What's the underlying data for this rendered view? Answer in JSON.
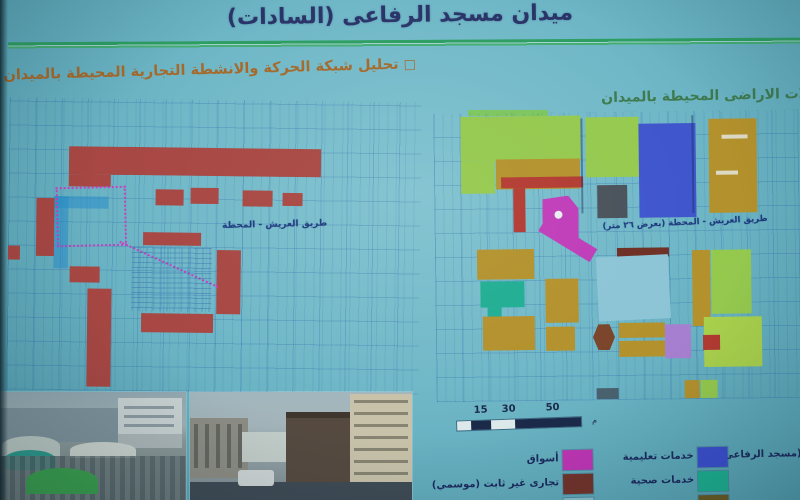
{
  "title": "ميدان مسجد الرفاعى (السادات)",
  "left_panel": {
    "bullet": "□",
    "header": "تحليل شبكة الحركة والانشطة التجارية المحيطة بالميدان",
    "street_label": "طريق العريش - المحطة"
  },
  "right_panel": {
    "header": "استعمالات الاراضى المحيطة بالميدان",
    "street_label": "طريق العريش - المحطة (بعرض ٢٦ متر)"
  },
  "scale_bar": {
    "ticks": [
      "15",
      "30",
      "50"
    ],
    "unit": "م"
  },
  "legend": {
    "items": [
      {
        "label": "(مسجد الرفاعى)",
        "color": "",
        "col": 0,
        "row": 0
      },
      {
        "label": "خدمات تعليمية",
        "color": "#3b4fd0",
        "col": 1,
        "row": 0
      },
      {
        "label": "أسواق",
        "color": "#bf35b5",
        "col": 2,
        "row": 0
      },
      {
        "label": "خدمات صحية",
        "color": "#1db191",
        "col": 1,
        "row": 1
      },
      {
        "label": "تجارى غير ثابت (موسمي)",
        "color": "#73332a",
        "col": 2,
        "row": 1
      },
      {
        "label": "",
        "color": "#6b5b22",
        "col": 1,
        "row": 2
      },
      {
        "label": "",
        "color": "#8cc0d0",
        "col": 2,
        "row": 2
      }
    ]
  },
  "colors": {
    "background": "#6fb7c7",
    "green_rule": "#2d9e62",
    "title_text": "#2a3468",
    "left_header_text": "#a5692b",
    "right_header_text": "#3e7a50",
    "grid_line": "#1e55a5",
    "commercial_red": "#a84743",
    "markets_magenta": "#bf35b5",
    "education_blue": "#3f55cc",
    "health_teal": "#1fae93",
    "residential_ochre": "#b3912c",
    "green_zone": "#95c94e",
    "lime_zone": "#a9d14c",
    "purple_zone": "#a77fd0",
    "mosque_brown": "#7a4429",
    "seasonal_maroon": "#6e2f24",
    "midan_lightblue": "#8cc4d6",
    "gray_zone": "#49525a"
  },
  "left_map": {
    "blocks": [
      {
        "x": 60,
        "y": 48,
        "w": 252,
        "h": 28,
        "c": "#a84743"
      },
      {
        "x": 60,
        "y": 76,
        "w": 42,
        "h": 12,
        "c": "#a84743"
      },
      {
        "x": 28,
        "y": 100,
        "w": 18,
        "h": 58,
        "c": "#a84743"
      },
      {
        "x": 80,
        "y": 190,
        "w": 24,
        "h": 98,
        "c": "#a84743"
      },
      {
        "x": 147,
        "y": 90,
        "w": 28,
        "h": 16,
        "c": "#a84743"
      },
      {
        "x": 182,
        "y": 88,
        "w": 28,
        "h": 16,
        "c": "#a84743"
      },
      {
        "x": 234,
        "y": 90,
        "w": 30,
        "h": 16,
        "c": "#a84743"
      },
      {
        "x": 274,
        "y": 92,
        "w": 20,
        "h": 13,
        "c": "#a84743"
      },
      {
        "x": 135,
        "y": 133,
        "w": 58,
        "h": 13,
        "c": "#a84743"
      },
      {
        "x": 209,
        "y": 150,
        "w": 24,
        "h": 64,
        "c": "#a84743"
      },
      {
        "x": 134,
        "y": 214,
        "w": 72,
        "h": 19,
        "c": "#a84743"
      },
      {
        "x": 62,
        "y": 168,
        "w": 30,
        "h": 16,
        "c": "#a84743"
      },
      {
        "x": 0,
        "y": 148,
        "w": 12,
        "h": 14,
        "c": "#a84743"
      },
      {
        "x": 46,
        "y": 98,
        "w": 14,
        "h": 72,
        "c": "rgba(40,140,200,0.55)"
      },
      {
        "x": 46,
        "y": 98,
        "w": 54,
        "h": 12,
        "c": "rgba(40,140,200,0.55)"
      }
    ]
  },
  "right_map": {
    "blocks": [
      {
        "x": 27,
        "y": 3,
        "w": 120,
        "h": 45,
        "c": "#95c94e"
      },
      {
        "x": 27,
        "y": 48,
        "w": 34,
        "h": 32,
        "c": "#95c94e"
      },
      {
        "x": 62,
        "y": 46,
        "w": 84,
        "h": 30,
        "c": "#b3912c"
      },
      {
        "x": 67,
        "y": 64,
        "w": 82,
        "h": 11,
        "c": "#b23a32"
      },
      {
        "x": 79,
        "y": 75,
        "w": 12,
        "h": 44,
        "c": "#b23a32"
      },
      {
        "x": 152,
        "y": 5,
        "w": 53,
        "h": 60,
        "c": "#95c94e"
      },
      {
        "x": 205,
        "y": 12,
        "w": 57,
        "h": 94,
        "c": "#3f55cc"
      },
      {
        "x": 275,
        "y": 8,
        "w": 48,
        "h": 94,
        "c": "#b3912c"
      },
      {
        "x": 288,
        "y": 24,
        "w": 26,
        "h": 4,
        "c": "rgba(230,236,236,0.8)"
      },
      {
        "x": 282,
        "y": 60,
        "w": 22,
        "h": 4,
        "c": "rgba(230,236,236,0.8)"
      },
      {
        "x": 163,
        "y": 73,
        "w": 30,
        "h": 33,
        "c": "#49525a"
      },
      {
        "x": 108,
        "y": 83,
        "w": 36,
        "h": 43,
        "c": "#bf3cb8",
        "shape": "pent"
      },
      {
        "x": 120,
        "y": 98,
        "w": 8,
        "h": 8,
        "c": "#e8eef0",
        "shape": "dot"
      },
      {
        "x": 103,
        "y": 120,
        "w": 60,
        "h": 15,
        "c": "#bf3cb8",
        "r": 32
      },
      {
        "x": 147,
        "y": 6,
        "w": 2,
        "h": 95,
        "c": "rgba(25,45,95,0.45)"
      },
      {
        "x": 258,
        "y": 4,
        "w": 2,
        "h": 98,
        "c": "rgba(25,45,95,0.45)"
      },
      {
        "x": 182,
        "y": 136,
        "w": 52,
        "h": 9,
        "c": "#6e2f24"
      },
      {
        "x": 162,
        "y": 144,
        "w": 72,
        "h": 64,
        "c": "#8cc4d6",
        "r": -2
      },
      {
        "x": 42,
        "y": 136,
        "w": 57,
        "h": 30,
        "c": "#b3912c"
      },
      {
        "x": 45,
        "y": 168,
        "w": 44,
        "h": 26,
        "c": "#1fae93"
      },
      {
        "x": 52,
        "y": 194,
        "w": 14,
        "h": 22,
        "c": "#1fae93"
      },
      {
        "x": 47,
        "y": 203,
        "w": 52,
        "h": 34,
        "c": "#b3912c"
      },
      {
        "x": 110,
        "y": 166,
        "w": 33,
        "h": 44,
        "c": "#b3912c"
      },
      {
        "x": 110,
        "y": 214,
        "w": 29,
        "h": 24,
        "c": "#b3912c"
      },
      {
        "x": 157,
        "y": 212,
        "w": 22,
        "h": 26,
        "c": "#7a4429",
        "shape": "hex"
      },
      {
        "x": 183,
        "y": 211,
        "w": 46,
        "h": 15,
        "c": "#b3912c"
      },
      {
        "x": 183,
        "y": 229,
        "w": 46,
        "h": 16,
        "c": "#b3912c"
      },
      {
        "x": 229,
        "y": 213,
        "w": 26,
        "h": 34,
        "c": "#a77fd0"
      },
      {
        "x": 257,
        "y": 139,
        "w": 18,
        "h": 76,
        "c": "#b3912c"
      },
      {
        "x": 276,
        "y": 139,
        "w": 40,
        "h": 64,
        "c": "#95c94e"
      },
      {
        "x": 268,
        "y": 206,
        "w": 58,
        "h": 50,
        "c": "#a9d14c"
      },
      {
        "x": 267,
        "y": 224,
        "w": 17,
        "h": 15,
        "c": "#b23a32"
      },
      {
        "x": 248,
        "y": 269,
        "w": 15,
        "h": 18,
        "c": "#b3912c"
      },
      {
        "x": 264,
        "y": 269,
        "w": 17,
        "h": 18,
        "c": "#95c94e"
      },
      {
        "x": 160,
        "y": 276,
        "w": 22,
        "h": 11,
        "c": "#49606e"
      }
    ]
  }
}
